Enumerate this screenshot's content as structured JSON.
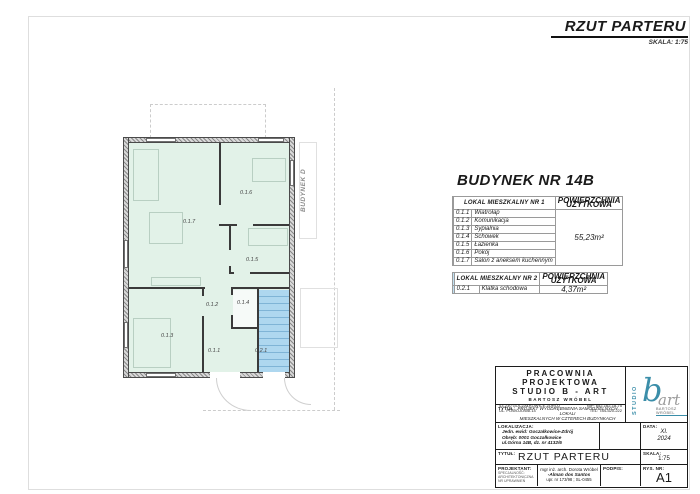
{
  "sheet": {
    "title": "RZUT PARTERU",
    "scale_note": "SKALA: 1:75"
  },
  "building_heading": "BUDYNEK NR 14B",
  "plan": {
    "neighbor_label": "BUDYNEK D",
    "room_labels": [
      "0.1.6",
      "0.1.7",
      "0.1.5",
      "0.1.2",
      "0.1.4",
      "0.1.3",
      "0.1.1",
      "0.2.1"
    ]
  },
  "tables": {
    "lokal1": {
      "header": "LOKAL MIESZKALNY NR 1",
      "area_header_line1": "POWIERZCHNIA",
      "area_header_line2": "UŻYTKOWA",
      "area": "55,23m²",
      "swatch_color": "#dcf0e3",
      "rows": [
        {
          "no": "0.1.1",
          "name": "Wiatrołap"
        },
        {
          "no": "0.1.2",
          "name": "Komunikacja"
        },
        {
          "no": "0.1.3",
          "name": "Sypialnia"
        },
        {
          "no": "0.1.4",
          "name": "Schowek"
        },
        {
          "no": "0.1.5",
          "name": "Łazienka"
        },
        {
          "no": "0.1.6",
          "name": "Pokój"
        },
        {
          "no": "0.1.7",
          "name": "Salon z aneksem kuchennym"
        }
      ]
    },
    "lokal2": {
      "header": "LOKAL MIESZKALNY NR 2",
      "area_header_line1": "POWIERZCHNIA",
      "area_header_line2": "UŻYTKOWA",
      "area": "4,37m²",
      "swatch_color": "#bfe0f2",
      "rows": [
        {
          "no": "0.2.1",
          "name": "Klatka schodowa"
        }
      ]
    }
  },
  "titleblock": {
    "company_line1": "PRACOWNIA PROJEKTOWA",
    "company_line2": "STUDIO B - ART",
    "company_line3": "BARTOSZ WRÓBEL",
    "address_line1": "43-230 GOCZAŁKOWICE-ZDRÓJ",
    "address_line2": "UL. POWOJOWA 14",
    "nip": "NIP: 652-162-18-75",
    "tel": "TEL: 784-520-222",
    "tytul_label": "TYTUŁ:",
    "project_title_lines": {
      "0": "PROJEKT WYODRĘBNIENIA SAMODZIELNYCH LOKALI",
      "1": "MIESZKALNYCH W CZTERECH BUDYNKACH MIESZKALNYCH",
      "2": "JEDNORODZINNYCH, DWULOKALOWYCH",
      "3": "W ZABUDOWIE BLIŹNIACZEJ"
    },
    "lokalizacja_label": "LOKALIZACJA:",
    "lokalizacja_lines": {
      "0": "Jedn. ewid: Goczałkowice-Zdrój",
      "1": "Obręb: 0001 Goczałkowice",
      "2": "ul.Górna 14B, dz. nr 4132/6"
    },
    "data_label": "DATA:",
    "data_value_line1": "XI.",
    "data_value_line2": "2024",
    "drawing_title_label": "TYTUŁ:",
    "drawing_title": "RZUT PARTERU",
    "skala_label": "SKALA:",
    "skala_value": "1:75",
    "projektant_label": "PROJEKTANT:",
    "projektant_sub": {
      "0": "SPECJALNOŚĆ:",
      "1": "ARCHITEKTONICZNA",
      "2": "NR UPRAWNIEŃ"
    },
    "projektant_name1": "mgr inż. arch. Dorota Wróbel",
    "projektant_name2": "-Alman dos Santos",
    "projektant_upr": "upr. nr 173/98 ; SL-0455",
    "podpis_label": "PODPIS:",
    "rys_label": "RYS. NR:",
    "rys_value": "A1",
    "logo": {
      "studio": "STUDIO",
      "b": "b",
      "art": "art",
      "name": "BARTOSZ WRÓBEL"
    }
  },
  "colors": {
    "room_fill_green": "#e2f2e8",
    "staircase_fill_blue": "#aed7ef",
    "logo_teal": "#3b8ea9",
    "wall_hatch_gray": "#9f9f9f"
  }
}
